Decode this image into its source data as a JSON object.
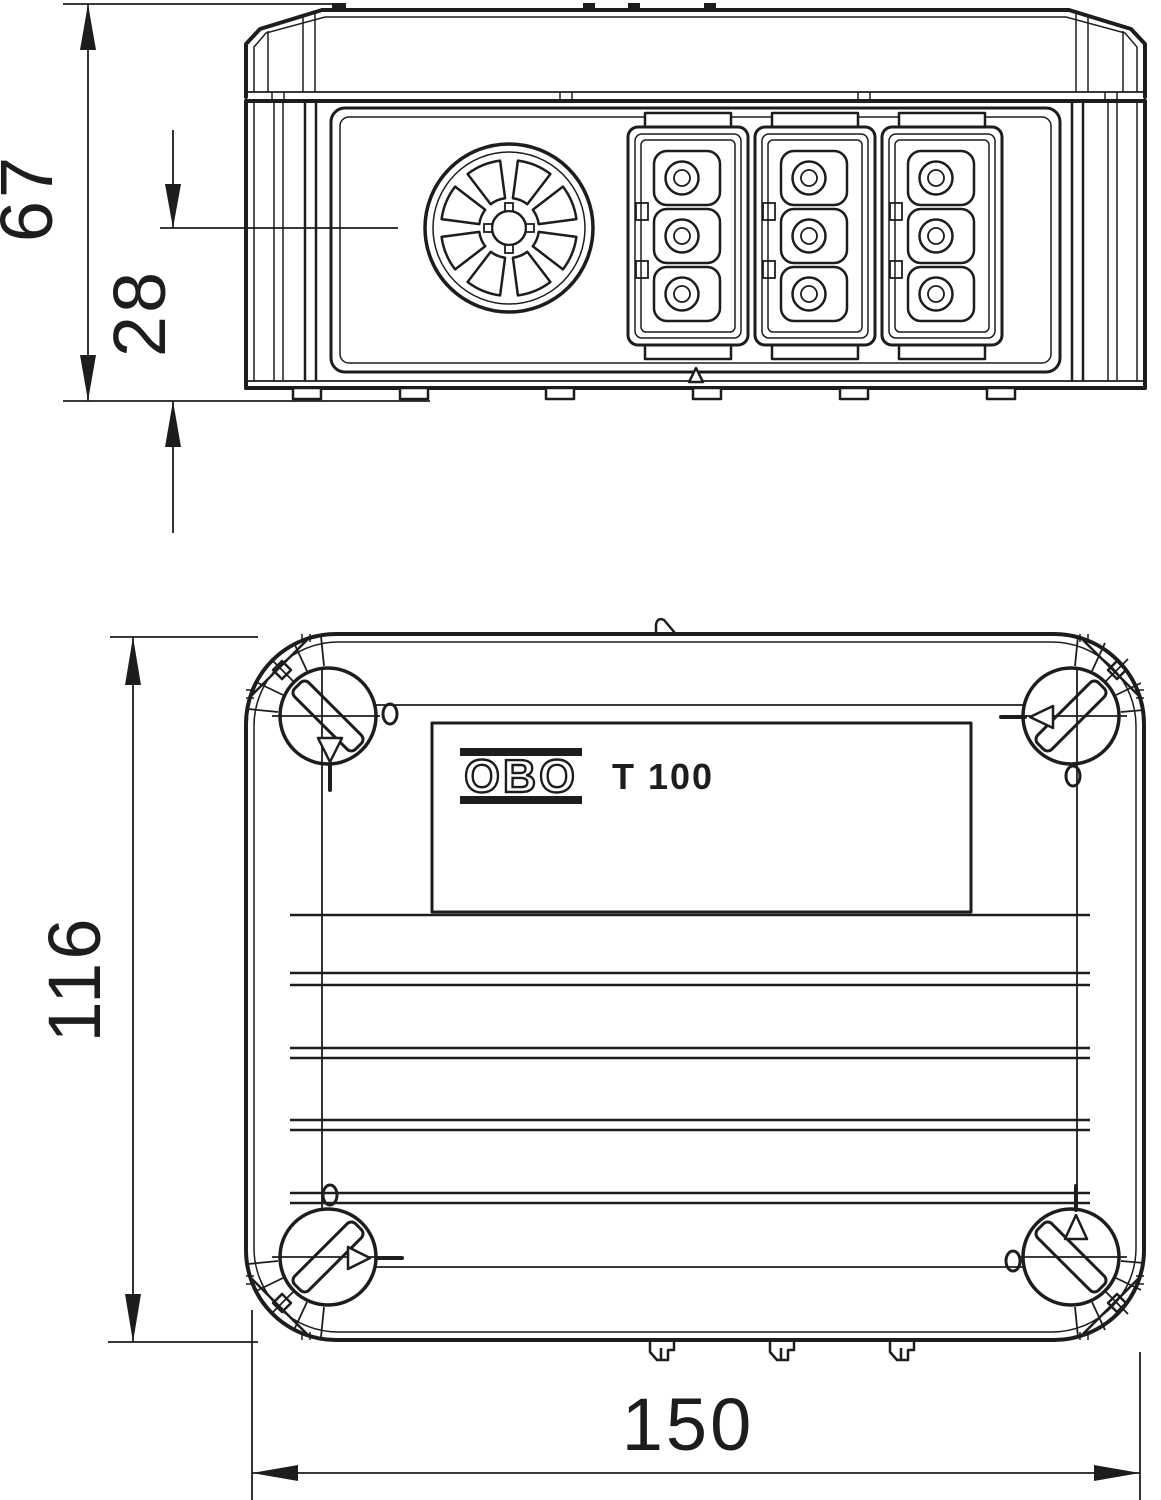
{
  "page": {
    "background": "#ffffff",
    "line_color": "#1d1d1b",
    "description": "Dimensional technical drawing of junction box, side elevation and plan view"
  },
  "product": {
    "brand_logo": "OBO",
    "model": "T 100"
  },
  "dimension_labels": {
    "side_total_height": "67",
    "side_entry_center_height": "28",
    "plan_depth": "116",
    "plan_width": "150"
  }
}
